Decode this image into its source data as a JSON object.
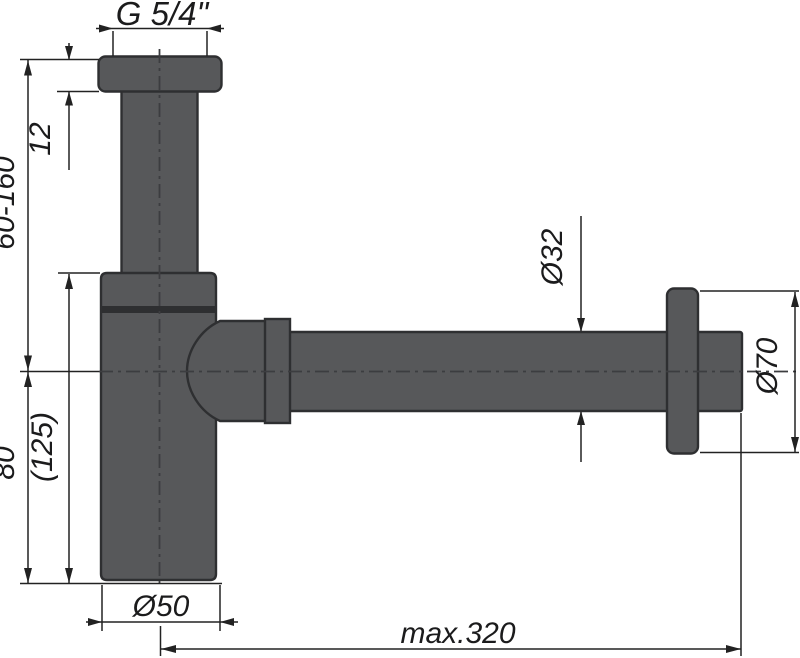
{
  "drawing": {
    "labels": {
      "thread_size": "G 5/4\"",
      "flange_height": "12",
      "adjustable_height": "60-160",
      "lower_body_height": "80",
      "total_body_height": "(125)",
      "body_diameter": "Ø50",
      "pipe_diameter": "Ø32",
      "rosette_diameter": "Ø70",
      "max_length": "max.320"
    },
    "colors": {
      "background": "#ffffff",
      "metal_fill": "#57585a",
      "metal_outline": "#2e2f31",
      "dimension_line": "#222222",
      "centerline": "#3c3d40",
      "label_text": "#1b1b1c"
    }
  }
}
